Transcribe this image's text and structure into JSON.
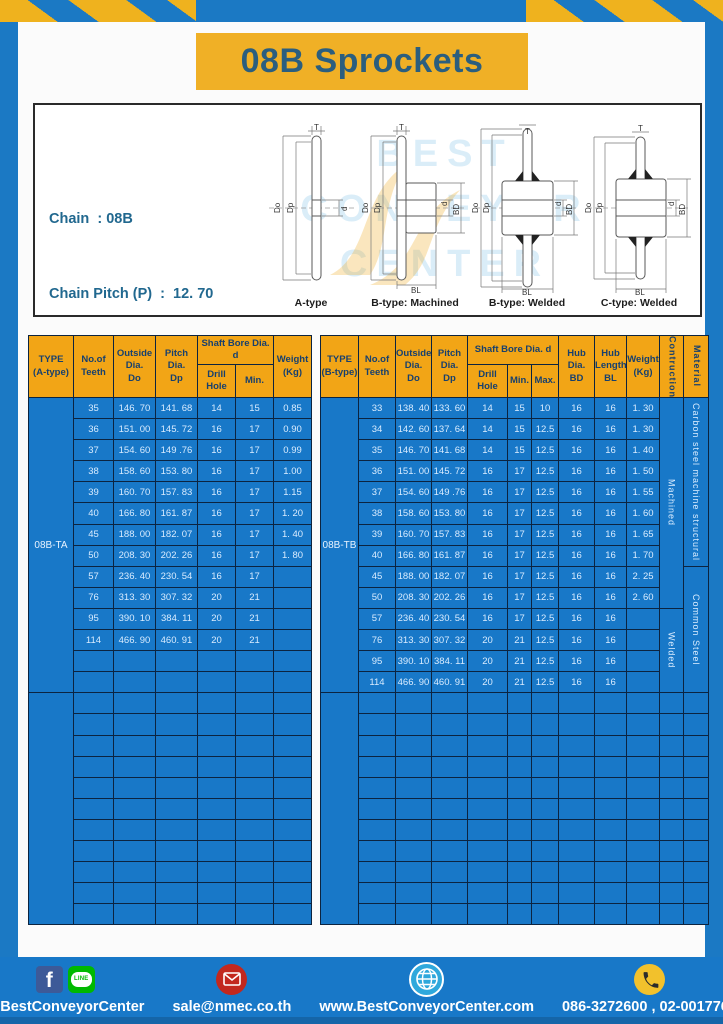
{
  "page": {
    "title": "08B Sprockets"
  },
  "specs": {
    "lines": [
      "Chain  : 08B",
      "Chain Pitch (P)  :  12. 70",
      "Roller Link Inside Width (W)  :  7.75",
      "Roller Diameter (Dr)  : 8.51",
      "Teeth Width (T)  :  7.2"
    ]
  },
  "watermark": {
    "line1": "BEST",
    "line2": "CONVEYOR",
    "line3": "CENTER"
  },
  "drawings": {
    "captions": [
      "A-type",
      "B-type: Machined",
      "B-type: Welded",
      "C-type: Welded"
    ],
    "dims": {
      "t": "T",
      "do": "Do",
      "dp": "Dp",
      "d": "d",
      "bd": "BD",
      "bl": "BL"
    }
  },
  "left_table": {
    "headers": {
      "type": "TYPE\n(A-type)",
      "teeth": "No.of\nTeeth",
      "outside": "Outside\nDia.\nDo",
      "pitch": "Pitch Dia.\nDp",
      "shaft_bore": "Shaft Bore Dia. d",
      "drill": "Drill Hole",
      "min": "Min.",
      "weight": "Weight\n(Kg)"
    },
    "type_label": "08B-TA",
    "rows": [
      [
        "35",
        "146. 70",
        "141. 68",
        "14",
        "15",
        "0.85"
      ],
      [
        "36",
        "151. 00",
        "145. 72",
        "16",
        "17",
        "0.90"
      ],
      [
        "37",
        "154. 60",
        "149 .76",
        "16",
        "17",
        "0.99"
      ],
      [
        "38",
        "158. 60",
        "153. 80",
        "16",
        "17",
        "1.00"
      ],
      [
        "39",
        "160. 70",
        "157. 83",
        "16",
        "17",
        "1.15"
      ],
      [
        "40",
        "166. 80",
        "161. 87",
        "16",
        "17",
        "1. 20"
      ],
      [
        "45",
        "188. 00",
        "182. 07",
        "16",
        "17",
        "1. 40"
      ],
      [
        "50",
        "208. 30",
        "202. 26",
        "16",
        "17",
        "1. 80"
      ],
      [
        "57",
        "236. 40",
        "230. 54",
        "16",
        "17",
        ""
      ],
      [
        "76",
        "313. 30",
        "307. 32",
        "20",
        "21",
        ""
      ],
      [
        "95",
        "390. 10",
        "384. 11",
        "20",
        "21",
        ""
      ],
      [
        "114",
        "466. 90",
        "460. 91",
        "20",
        "21",
        ""
      ]
    ],
    "empty_rows_group1": 2,
    "empty_rows_group2": 11
  },
  "right_table": {
    "headers": {
      "type": "TYPE\n(B-type)",
      "teeth": "No.of\nTeeth",
      "outside": "Outside\nDia.\nDo",
      "pitch": "Pitch Dia.\nDp",
      "shaft_bore": "Shaft Bore Dia. d",
      "drill": "Drill Hole",
      "min": "Min.",
      "max": "Max.",
      "hub_dia": "Hub Dia.\nBD",
      "hub_len": "Hub\nLength\nBL",
      "weight": "Weight\n(Kg)",
      "construction": "Contruction",
      "material": "Material"
    },
    "type_label": "08B-TB",
    "rows": [
      [
        "33",
        "138. 40",
        "133. 60",
        "14",
        "15",
        "10",
        "16",
        "16",
        "1. 30"
      ],
      [
        "34",
        "142. 60",
        "137. 64",
        "14",
        "15",
        "12.5",
        "16",
        "16",
        "1. 30"
      ],
      [
        "35",
        "146. 70",
        "141. 68",
        "14",
        "15",
        "12.5",
        "16",
        "16",
        "1. 40"
      ],
      [
        "36",
        "151. 00",
        "145. 72",
        "16",
        "17",
        "12.5",
        "16",
        "16",
        "1. 50"
      ],
      [
        "37",
        "154. 60",
        "149 .76",
        "16",
        "17",
        "12.5",
        "16",
        "16",
        "1. 55"
      ],
      [
        "38",
        "158. 60",
        "153. 80",
        "16",
        "17",
        "12.5",
        "16",
        "16",
        "1. 60"
      ],
      [
        "39",
        "160. 70",
        "157. 83",
        "16",
        "17",
        "12.5",
        "16",
        "16",
        "1. 65"
      ],
      [
        "40",
        "166. 80",
        "161. 87",
        "16",
        "17",
        "12.5",
        "16",
        "16",
        "1. 70"
      ],
      [
        "45",
        "188. 00",
        "182. 07",
        "16",
        "17",
        "12.5",
        "16",
        "16",
        "2. 25"
      ],
      [
        "50",
        "208. 30",
        "202. 26",
        "16",
        "17",
        "12.5",
        "16",
        "16",
        "2. 60"
      ],
      [
        "57",
        "236. 40",
        "230. 54",
        "16",
        "17",
        "12.5",
        "16",
        "16",
        ""
      ],
      [
        "76",
        "313. 30",
        "307. 32",
        "20",
        "21",
        "12.5",
        "16",
        "16",
        ""
      ],
      [
        "95",
        "390. 10",
        "384. 11",
        "20",
        "21",
        "12.5",
        "16",
        "16",
        ""
      ],
      [
        "114",
        "466. 90",
        "460. 91",
        "20",
        "21",
        "12.5",
        "16",
        "16",
        ""
      ]
    ],
    "construction_groups": [
      {
        "label": "Machined",
        "rows": 10
      },
      {
        "label": "Welded",
        "rows": 4
      }
    ],
    "material_groups": [
      {
        "label": "Carbon steel  machine structural",
        "rows": 8
      },
      {
        "label": "Common  Steel",
        "rows": 6
      }
    ],
    "empty_rows_group2": 11
  },
  "footer": {
    "facebook_f": "f",
    "line_icon_text": "LINE",
    "facebook_label": "@BestConveyorCenter",
    "email": "sale@nmec.co.th",
    "website": "www.BestConveyorCenter.com",
    "phones": "086-3272600 , 02-0017766"
  },
  "colors": {
    "frame_blue": "#1B79C4",
    "table_blue": "#1878C8",
    "hazard_yellow": "#EFB21E",
    "banner_yellow": "#F0B026",
    "header_orange": "#F2A516",
    "title_text": "#2B5E7E",
    "cell_border": "#0C2440",
    "footer_divider": "#F0C020"
  }
}
